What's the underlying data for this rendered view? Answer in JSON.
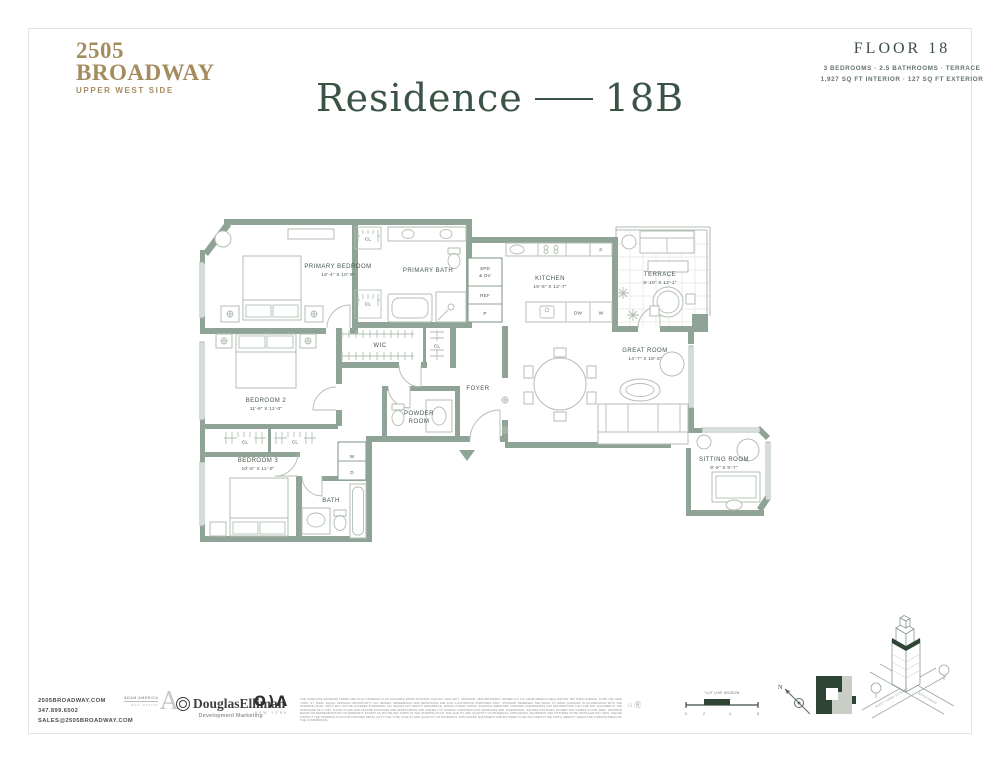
{
  "colors": {
    "wall": "#8fa396",
    "accent_green": "#3a5345",
    "brand_gold": "#a58c5e",
    "keyplan_dark": "#2e4434"
  },
  "header": {
    "brand_line1": "2505",
    "brand_line2": "BROADWAY",
    "brand_tagline": "UPPER WEST SIDE",
    "floor_title": "FLOOR 18",
    "floor_spec_line1": "3 BEDROOMS · 2.5 BATHROOMS · TERRACE",
    "floor_spec_line2": "1,927 SQ FT INTERIOR · 127 SQ FT EXTERIOR",
    "residence_title_left": "Residence",
    "residence_title_right": "18B"
  },
  "plan": {
    "rooms": {
      "primary_bedroom": {
        "name": "PRIMARY BEDROOM",
        "dims": "18'-4\" X 10'-9\""
      },
      "primary_bath": {
        "name": "PRIMARY BATH"
      },
      "wic": {
        "name": "WIC"
      },
      "kitchen": {
        "name": "KITCHEN",
        "dims": "15'-6\" X 12'-7\""
      },
      "terrace": {
        "name": "TERRACE",
        "dims": "8'-10\" X 12'-1\""
      },
      "great_room": {
        "name": "GREAT ROOM",
        "dims": "14'-7\" X 18'-3\""
      },
      "sitting_room": {
        "name": "SITTING ROOM",
        "dims": "9'-5\" X 9'-7\""
      },
      "foyer": {
        "name": "FOYER"
      },
      "powder_room": {
        "line1": "POWDER",
        "line2": "ROOM"
      },
      "bedroom_2": {
        "name": "BEDROOM 2",
        "dims": "11'-8\" X 11'-0\""
      },
      "bedroom_3": {
        "name": "BEDROOM 3",
        "dims": "10'-6\" X 11'-0\""
      },
      "bath": {
        "name": "BATH"
      }
    },
    "fixtures": {
      "cl": "CL",
      "washer": "W",
      "dryer": "D",
      "ref": "REF",
      "spd_line1": "SPD",
      "spd_line2": "& OV",
      "pantry": "P",
      "dw": "DW",
      "wine": "W"
    }
  },
  "footer": {
    "website": "2505BROADWAY.COM",
    "phone": "347.899.6502",
    "email": "SALES@2505BROADWAY.COM",
    "adam_america_name": "ADAM AMERICA",
    "adam_america_sub": "REAL ESTATE",
    "adam_america_mark": "A",
    "elliman_name": "DouglasElliman",
    "elliman_sub": "Development Marketing",
    "oda_letters": "O)Λ",
    "oda_sub": "NEW YORK",
    "lot_line_note": "*LOT LINE WINDOW",
    "scale_ticks": [
      "0",
      "2",
      "4",
      "8"
    ],
    "compass_label": "N",
    "street_1": "WEST 93RD STREET",
    "street_2": "BROADWAY",
    "legal_icons": "⌂Ⓡ",
    "disclaimer": "THE COMPLETE OFFERING TERMS ARE IN AN OFFERING PLAN AVAILABLE FROM SPONSOR. FILE NO. CD21-0277. SPONSOR: 2505 BROADWAY OWNER LLC C/O ADAM AMERICA REAL ESTATE, 850 THIRD AVENUE, SUITE 13D, NEW YORK, NY 10022. EQUAL HOUSING OPPORTUNITY. ALL IMAGES, RENDERINGS AND DEPICTIONS ARE FOR ILLUSTRATIVE PURPOSES ONLY. SPONSOR RESERVES THE RIGHT TO MAKE CHANGES IN ACCORDANCE WITH THE OFFERING PLAN. UNITS WILL NOT BE OFFERED FURNISHED. ALL IMAGES MAY DEPICT, REFERENCE, AMONG OTHER THINGS, BUILDING AMENITIES, FINISHES, FURNISHINGS AND DECORATIONS THAT ARE NOT INCLUDED IN THE PURCHASE OF A UNIT. FLOOR PLANS AND SQUARE FOOTAGES ARE APPROXIMATE AND SUBJECT TO NORMAL CONSTRUCTION VARIANCES AND TOLERANCES. SQUARE FOOTAGES EXCEED THE USABLE FLOOR AREA. SPONSOR MAKES NO REPRESENTATION OR WARRANTY EXCEPT AS MAY BE SET FORTH IN THE OFFERING PLAN. THE QUALITY AND QUANTITY OF MATERIALS, APPLIANCES, EQUIPMENT AND FIXTURES TO BE INSTALLED MAY VARY. PLEASE CONSULT THE OFFERING PLAN FOR FURTHER DETAIL AS TO THE TYPE, QUALITY AND QUANTITY OF MATERIALS, APPLIANCES, EQUIPMENT AND FIXTURES TO BE INCLUDED IN THE UNITS, AMENITY AREAS AND COMMON AREAS OF THE CONDOMINIUM."
  }
}
